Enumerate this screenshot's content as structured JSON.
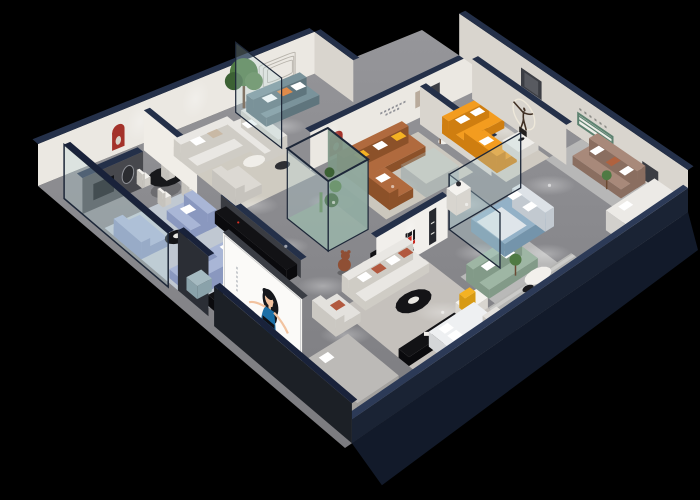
{
  "scene": {
    "type": "isometric-3d-showroom-render",
    "description": "3D cutaway floor plan render of a furniture showroom on a black background",
    "brand": {
      "logo_text": "华悦"
    },
    "palette": {
      "background": "#000000",
      "floor_hi": "#9a9a9e",
      "floor_lo": "#7c7c80",
      "wall_white": "#ebe8e2",
      "wall_shade": "#d9d5ce",
      "wall_cap": "#243049",
      "wall_cap_dark": "#19223a",
      "wall_dark_feature": "#47484d",
      "storefront_dark": "#2b2e35",
      "front_wall": "#1c2026",
      "outer_band": "#121a2a",
      "glass_fill": "rgba(186,214,218,0.30)",
      "glass_frame": "#1d2738",
      "rug_blue": "#c6cfd9",
      "rug_warm": "#d6d1c6",
      "rug_tan": "#dbd5c9",
      "rug_front": "#ccc8c2",
      "rug_gray": "#c2c2c0",
      "stripe_a": "#b5b5b3",
      "stripe_b": "#cbcbc9",
      "sofa_white": "#e9e7e3",
      "sofa_white_dark": "#cfccc5",
      "sofa_periwinkle": "#a9b6d6",
      "sofa_periwinkle_dark": "#8a98bf",
      "sofa_teal": "#7a939b",
      "sofa_teal_dark": "#5f757d",
      "sofa_caramel": "#b06a3e",
      "sofa_caramel_dark": "#8c5129",
      "sofa_orange": "#f39c1f",
      "sofa_orange_dark": "#cf7e10",
      "sofa_sage": "#9eb6a4",
      "sofa_sage_dark": "#829a88",
      "sofa_taupe": "#a8897a",
      "sofa_taupe_dark": "#8a6e60",
      "bed_blue": "#93b1c7",
      "bed_blue_dark": "#7494ab",
      "white": "#f4f2ee",
      "off_white": "#e3e1dc",
      "black_furn": "#121215",
      "black_furn_dark": "#0a0a0d",
      "accent_rust": "#b2593f",
      "accent_yellow": "#f4b223",
      "accent_orange": "#e08b4a",
      "red_niche": "#a4322a",
      "red_niche_dark": "#7e241e",
      "green_leaf_1": "#4f7a43",
      "green_leaf_2": "#3c6134",
      "green_leaf_3": "#5c854e",
      "trunk_brown": "#6b4a33",
      "bear_brown": "#8f4f34",
      "shelf_green": "#5d8270",
      "skin": "#f2c3a0",
      "dress_blue": "#1c6fa6",
      "hair_black": "#15171c",
      "dash_gray": "#8f9096",
      "art_beige": "#b9ab9c",
      "art_dark": "#3c3e44",
      "stool_blue": "#a5bac1",
      "logo_red": "#c9251c",
      "logo_black": "#19191c",
      "ring_cream": "#eee8da",
      "led_red": "#d93025",
      "terrarium_green": "#7f9888"
    }
  }
}
